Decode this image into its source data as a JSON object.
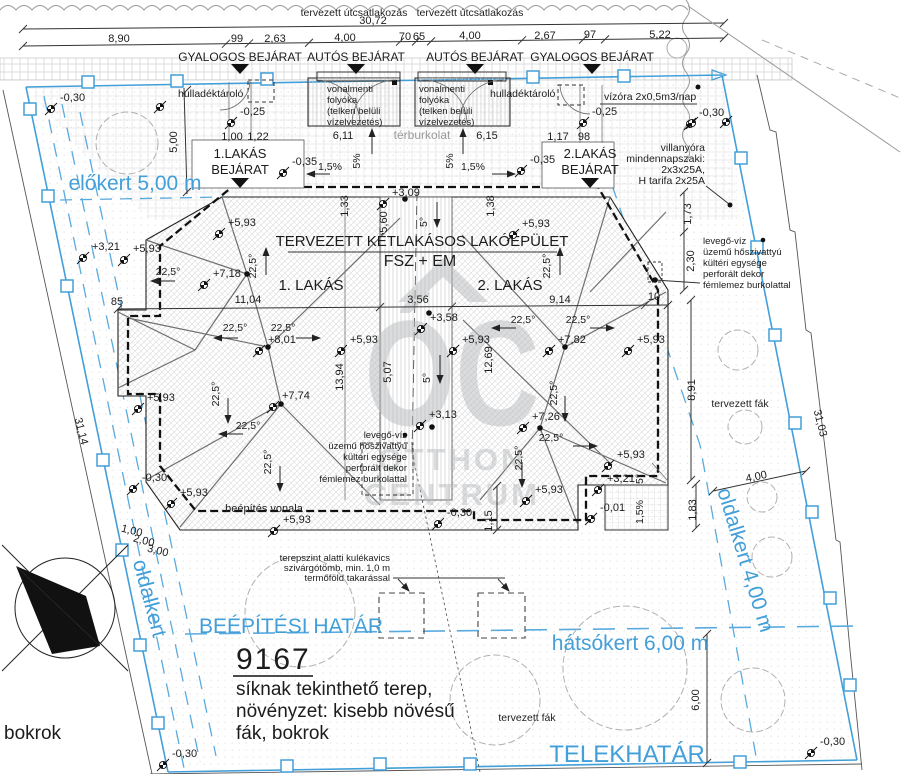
{
  "street": {
    "connection_label_1": "tervezett útcsatlakozás",
    "connection_label_2": "tervezett útcsatlakozás",
    "total_width": "30,72",
    "entrances": [
      {
        "label": "GYALOGOS BEJÁRAT",
        "x": 240
      },
      {
        "label": "AUTÓS BEJÁRAT",
        "x": 356
      },
      {
        "label": "AUTÓS BEJÁRAT",
        "x": 475
      },
      {
        "label": "GYALOGOS BEJÁRAT",
        "x": 592
      }
    ]
  },
  "zones": {
    "front": "előkert 5,00 m",
    "left": "oldalkert",
    "right": "oldalkert 4,00 m",
    "back": "hátsókert 6,00 m",
    "building_limit": "BEÉPÍTÉSI HATÁR",
    "boundary": "TELEKHATÁR"
  },
  "parcel": {
    "number": "9167",
    "terrain_lines": [
      "síknak tekinthető terep,",
      "növényzet: kisebb növésű",
      "fák, bokrok"
    ],
    "shrubs": "bokrok",
    "planned_trees": "tervezett fák",
    "planned_trees_2": "tervezett fák"
  },
  "building": {
    "title": "TERVEZETT KÉTLAKÁSOS LAKÓÉPÜLET",
    "subtitle": "FSZ + EM",
    "flat1": "1. LAKÁS",
    "flat2": "2. LAKÁS",
    "entrance1_l1": "1.LAKÁS",
    "entrance1_l2": "BEJÁRAT",
    "entrance2_l1": "2.LAKÁS",
    "entrance2_l2": "BEJÁRAT",
    "line_label": "beépítés vonala"
  },
  "notes": {
    "waste": "hulladéktároló",
    "paving": "térburkolat",
    "water_meter": "vízóra 2x0,5m3/nap",
    "gutter_lines": [
      "vonalmenti",
      "folyóka",
      "(telken belüli",
      "vízelvezetés)"
    ],
    "electric_lines": [
      "villanyóra",
      "mindennapszaki:",
      "2x3x25A,",
      "H tarifa 2x25A"
    ],
    "heatpump_lines": [
      "levegő-víz",
      "üzemű hőszivattyú",
      "kültéri egysége",
      "perforált dekor",
      "fémlemez burkolattal"
    ],
    "drain_lines": [
      "terepszint alatti kulékavics",
      "szivárgótömb, min. 1,0 m",
      "termőföld takarással"
    ]
  },
  "watermark": {
    "monogram": "ÓC",
    "line1": "OTTHON",
    "line2": "CENTRUM"
  },
  "colors": {
    "boundary_blue": "#429fd9",
    "ink": "#1c1c1c",
    "watermark_gray": "#b6babd"
  },
  "marks": {
    "elevations": [
      [
        133,
        252,
        "+5,93"
      ],
      [
        228,
        226,
        "+5,93"
      ],
      [
        522,
        227,
        "+5,93"
      ],
      [
        147,
        401,
        "+5,93"
      ],
      [
        350,
        343,
        "+5,93"
      ],
      [
        462,
        343,
        "+5,93"
      ],
      [
        637,
        343,
        "+5,93"
      ],
      [
        617,
        458,
        "+5,93"
      ],
      [
        535,
        493,
        "+5,93"
      ],
      [
        180,
        496,
        "+5,93"
      ],
      [
        283,
        523,
        "+5,93"
      ],
      [
        213,
        277,
        "+7,18"
      ],
      [
        268,
        343,
        "+8,01"
      ],
      [
        282,
        399,
        "+7,74"
      ],
      [
        558,
        343,
        "+7,82"
      ],
      [
        532,
        420,
        "+7,26"
      ],
      [
        92,
        250,
        "+3,21"
      ],
      [
        607,
        482,
        "+3,21"
      ],
      [
        430,
        321,
        "+3,58"
      ],
      [
        429,
        418,
        "+3,13"
      ],
      [
        392,
        196,
        "+3,09"
      ],
      [
        600,
        511,
        "-0,01"
      ],
      [
        240,
        115,
        "-0,25"
      ],
      [
        592,
        115,
        "-0,25"
      ],
      [
        292,
        165,
        "-0,35"
      ],
      [
        530,
        163,
        "-0,35"
      ],
      [
        60,
        101,
        "-0,30"
      ],
      [
        699,
        116,
        "-0,30"
      ],
      [
        142,
        481,
        "-0,30"
      ],
      [
        447,
        516,
        "-0,30"
      ],
      [
        172,
        757,
        "-0,30"
      ],
      [
        820,
        745,
        "-0,30"
      ]
    ],
    "slopes": [
      [
        235,
        331,
        "22,5°",
        0
      ],
      [
        283,
        331,
        "22,5°",
        0
      ],
      [
        256,
        266,
        "22,5°",
        -90
      ],
      [
        550,
        266,
        "22,5°",
        -90
      ],
      [
        168,
        275,
        "22,5°",
        0
      ],
      [
        219,
        394,
        "22,5°",
        -90
      ],
      [
        248,
        429,
        "22,5°",
        0
      ],
      [
        271,
        462,
        "22,5°",
        -90
      ],
      [
        523,
        323,
        "22,5°",
        0
      ],
      [
        578,
        323,
        "22,5°",
        0
      ],
      [
        557,
        393,
        "22,5°",
        -90
      ],
      [
        551,
        441,
        "22,5°",
        0
      ],
      [
        522,
        458,
        "22,5°",
        -90
      ],
      [
        427,
        222,
        "5°",
        -90
      ],
      [
        430,
        378,
        "5°",
        -90
      ],
      [
        643,
        479,
        "5°",
        -90
      ],
      [
        360,
        161,
        "5%",
        -90
      ],
      [
        453,
        161,
        "5%",
        -90
      ],
      [
        330,
        170,
        "1,5%",
        0
      ],
      [
        473,
        170,
        "1,5%",
        0
      ],
      [
        643,
        512,
        "1,5%",
        -90
      ]
    ],
    "dims": [
      [
        119,
        42,
        "8,90",
        0
      ],
      [
        237,
        42,
        "99",
        0
      ],
      [
        275,
        42,
        "2,63",
        0
      ],
      [
        345,
        41,
        "4,00",
        0
      ],
      [
        405,
        40,
        "70",
        0
      ],
      [
        419,
        40,
        "65",
        0
      ],
      [
        470,
        39,
        "4,00",
        0
      ],
      [
        545,
        39,
        "2,67",
        0
      ],
      [
        590,
        38,
        "97",
        0
      ],
      [
        660,
        38,
        "5,22",
        0
      ],
      [
        373,
        24,
        "30,72",
        0
      ],
      [
        232,
        140,
        "1,00",
        0
      ],
      [
        258,
        140,
        "1,22",
        0
      ],
      [
        558,
        140,
        "1,17",
        0
      ],
      [
        584,
        140,
        "98",
        0
      ],
      [
        343,
        139,
        "6,11",
        0
      ],
      [
        487,
        139,
        "6,15",
        0
      ],
      [
        248,
        303,
        "11,04",
        0
      ],
      [
        418,
        303,
        "3,56",
        0
      ],
      [
        560,
        303,
        "9,14",
        0
      ],
      [
        654,
        300,
        "10",
        0
      ],
      [
        117,
        305,
        "85",
        0
      ],
      [
        348,
        206,
        "1,33",
        -90
      ],
      [
        494,
        206,
        "1,38",
        -90
      ],
      [
        387,
        222,
        "5,60",
        -90
      ],
      [
        391,
        372,
        "5,07",
        -90
      ],
      [
        343,
        377,
        "13,94",
        -90
      ],
      [
        492,
        360,
        "12,69",
        -90
      ],
      [
        177,
        142,
        "5,00",
        -90
      ],
      [
        691,
        214,
        "1,73",
        -90
      ],
      [
        694,
        261,
        "2,30",
        -90
      ],
      [
        695,
        390,
        "8,91",
        -90
      ],
      [
        696,
        510,
        "1,83",
        -90
      ],
      [
        492,
        521,
        "1,15",
        -90
      ],
      [
        757,
        480,
        "4,00",
        -12
      ],
      [
        699,
        700,
        "6,00",
        -90
      ],
      [
        78,
        432,
        "31,14",
        76
      ],
      [
        817,
        424,
        "31,03",
        76
      ],
      [
        131,
        534,
        "1,00",
        14
      ],
      [
        143,
        544,
        "2,00",
        14
      ],
      [
        157,
        554,
        "3,00",
        14
      ]
    ]
  }
}
